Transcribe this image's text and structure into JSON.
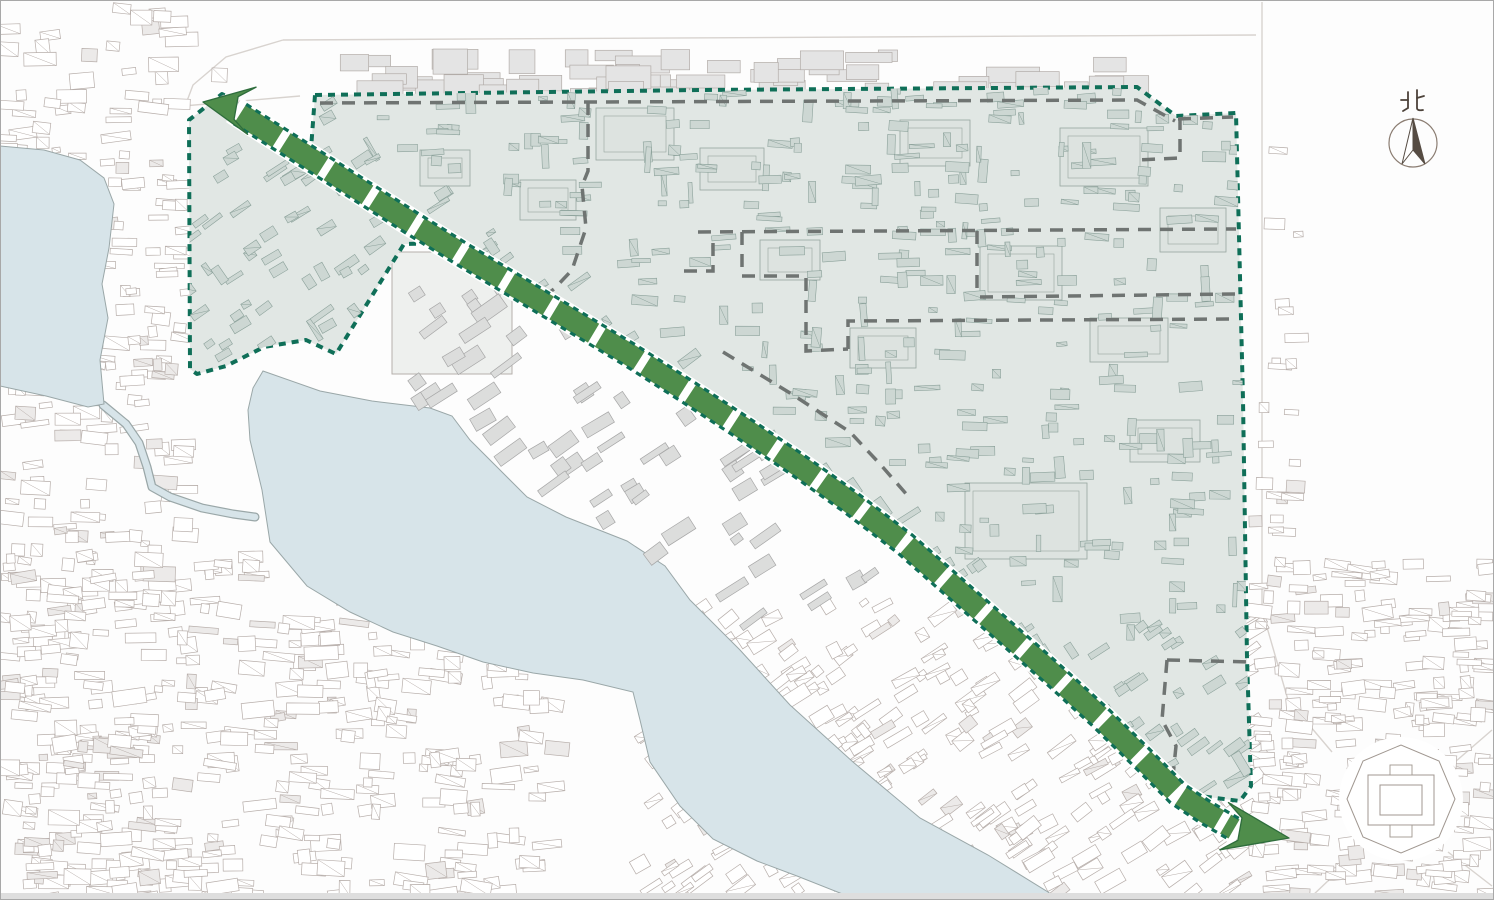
{
  "meta": {
    "width": 1494,
    "height": 900,
    "background": "#fdfdfd",
    "border_color": "#a8a8a8",
    "bottom_strip_color": "#dedede"
  },
  "compass": {
    "label": "北",
    "cx": 1413,
    "cy": 143,
    "r": 24,
    "ring_color": "#8b7d72",
    "needle_dark": "#564c43",
    "needle_light": "#ffffff",
    "label_color": "#4c423a"
  },
  "palette": {
    "water_fill": "#d7e4e9",
    "water_stroke": "#9aa7a8",
    "district_fill": "#e1e7e4",
    "district_boundary": "#0f6f58",
    "inside_bldg_fill": "#cdd7d3",
    "inside_bldg_stroke": "#8ba19a",
    "complex_fill": "#dde3e0",
    "complex_stroke": "#96a69f",
    "subzone_color": "#6f7472",
    "band_green": "#4f8d4b",
    "band_edge": "#0f6f58",
    "band_outline": "#2e6d3c",
    "road_color": "#d8d3cf",
    "outside_stroke": "#b7aeaa",
    "outside_fill": "#ffffff",
    "palace_fill": "#dcdddc",
    "palace_stroke": "#a7a7a7",
    "topstrip_fill": "#e4e4e4",
    "topstrip_stroke": "#b2aca8",
    "octagon_stroke": "#a09790"
  },
  "district": {
    "polygon": [
      [
        315,
        95
      ],
      [
        700,
        90
      ],
      [
        1137,
        87
      ],
      [
        1176,
        116
      ],
      [
        1236,
        113
      ],
      [
        1243,
        400
      ],
      [
        1247,
        658
      ],
      [
        1251,
        786
      ],
      [
        1240,
        801
      ],
      [
        1168,
        792
      ],
      [
        1128,
        748
      ],
      [
        1088,
        703
      ],
      [
        1046,
        662
      ],
      [
        996,
        618
      ],
      [
        946,
        574
      ],
      [
        896,
        530
      ],
      [
        841,
        488
      ],
      [
        786,
        449
      ],
      [
        731,
        412
      ],
      [
        676,
        376
      ],
      [
        621,
        341
      ],
      [
        566,
        308
      ],
      [
        511,
        275
      ],
      [
        456,
        243
      ],
      [
        404,
        244
      ],
      [
        336,
        354
      ],
      [
        306,
        340
      ],
      [
        264,
        347
      ],
      [
        226,
        366
      ],
      [
        197,
        374
      ],
      [
        190,
        369
      ],
      [
        189,
        120
      ],
      [
        222,
        94
      ],
      [
        256,
        111
      ],
      [
        290,
        133
      ],
      [
        311,
        149
      ]
    ],
    "boundary_width": 4,
    "boundary_dash": [
      7,
      6
    ]
  },
  "band": {
    "width": 22,
    "road_width": 29,
    "segment_dash": [
      45,
      8
    ],
    "edge_dash": [
      6,
      5
    ],
    "edge_width": 3.2,
    "edge_offset": 11.5,
    "centerline": [
      [
        240,
        114
      ],
      [
        300,
        152
      ],
      [
        355,
        187
      ],
      [
        410,
        222
      ],
      [
        465,
        256
      ],
      [
        520,
        289
      ],
      [
        575,
        322
      ],
      [
        630,
        355
      ],
      [
        685,
        390
      ],
      [
        740,
        426
      ],
      [
        795,
        463
      ],
      [
        850,
        502
      ],
      [
        905,
        544
      ],
      [
        955,
        588
      ],
      [
        1005,
        632
      ],
      [
        1055,
        676
      ],
      [
        1100,
        717
      ],
      [
        1140,
        756
      ],
      [
        1178,
        794
      ],
      [
        1205,
        812
      ],
      [
        1234,
        829
      ]
    ],
    "arrowheads": [
      {
        "tip": [
          203,
          102
        ],
        "base": [
          242,
          109
        ],
        "wing": 24,
        "back": 10,
        "notch": 11.5
      },
      {
        "tip": [
          1289,
          838
        ],
        "base": [
          1234,
          828
        ],
        "wing": 24,
        "back": 10,
        "notch": 11.5
      }
    ]
  },
  "water": {
    "big_lake": [
      [
        263,
        371
      ],
      [
        320,
        391
      ],
      [
        372,
        401
      ],
      [
        430,
        408
      ],
      [
        452,
        416
      ],
      [
        470,
        440
      ],
      [
        500,
        470
      ],
      [
        527,
        497
      ],
      [
        566,
        517
      ],
      [
        627,
        541
      ],
      [
        665,
        566
      ],
      [
        690,
        600
      ],
      [
        740,
        650
      ],
      [
        790,
        705
      ],
      [
        853,
        762
      ],
      [
        920,
        818
      ],
      [
        988,
        855
      ],
      [
        1048,
        892
      ],
      [
        1058,
        900
      ],
      [
        853,
        900
      ],
      [
        845,
        895
      ],
      [
        797,
        876
      ],
      [
        757,
        861
      ],
      [
        713,
        839
      ],
      [
        680,
        806
      ],
      [
        650,
        762
      ],
      [
        640,
        720
      ],
      [
        633,
        692
      ],
      [
        583,
        680
      ],
      [
        533,
        673
      ],
      [
        483,
        662
      ],
      [
        437,
        646
      ],
      [
        393,
        632
      ],
      [
        350,
        612
      ],
      [
        307,
        586
      ],
      [
        270,
        542
      ],
      [
        262,
        490
      ],
      [
        250,
        440
      ],
      [
        248,
        410
      ],
      [
        253,
        388
      ]
    ],
    "small_lake": [
      [
        0,
        146
      ],
      [
        44,
        150
      ],
      [
        80,
        160
      ],
      [
        104,
        178
      ],
      [
        114,
        204
      ],
      [
        109,
        248
      ],
      [
        102,
        284
      ],
      [
        108,
        318
      ],
      [
        100,
        360
      ],
      [
        104,
        404
      ],
      [
        88,
        407
      ],
      [
        46,
        396
      ],
      [
        0,
        386
      ]
    ],
    "canal": [
      [
        103,
        405
      ],
      [
        126,
        424
      ],
      [
        139,
        443
      ],
      [
        147,
        467
      ],
      [
        152,
        487
      ],
      [
        170,
        497
      ],
      [
        202,
        508
      ],
      [
        233,
        514
      ],
      [
        255,
        517
      ]
    ]
  },
  "subzones": {
    "width": 3.5,
    "dash": [
      13,
      9
    ],
    "lines": [
      [
        [
          320,
          103
        ],
        [
          1137,
          100
        ],
        [
          1175,
          121
        ]
      ],
      [
        [
          1178,
          119
        ],
        [
          1233,
          117
        ]
      ],
      [
        [
          588,
          102
        ],
        [
          588,
          171
        ],
        [
          582,
          186
        ],
        [
          586,
          228
        ],
        [
          572,
          270
        ],
        [
          554,
          289
        ],
        [
          534,
          304
        ]
      ],
      [
        [
          698,
          232
        ],
        [
          1236,
          229
        ]
      ],
      [
        [
          977,
          231
        ],
        [
          977,
          297
        ]
      ],
      [
        [
          980,
          297
        ],
        [
          1236,
          294
        ]
      ],
      [
        [
          742,
          232
        ],
        [
          742,
          276
        ],
        [
          806,
          276
        ],
        [
          806,
          351
        ],
        [
          848,
          349
        ]
      ],
      [
        [
          684,
          271
        ],
        [
          713,
          271
        ],
        [
          713,
          243
        ]
      ],
      [
        [
          848,
          349
        ],
        [
          848,
          321
        ],
        [
          1236,
          319
        ]
      ],
      [
        [
          723,
          352
        ],
        [
          790,
          393
        ],
        [
          850,
          432
        ],
        [
          880,
          464
        ],
        [
          908,
          496
        ]
      ],
      [
        [
          1167,
          660
        ],
        [
          1252,
          662
        ]
      ],
      [
        [
          1167,
          660
        ],
        [
          1162,
          720
        ],
        [
          1176,
          746
        ],
        [
          1172,
          786
        ]
      ],
      [
        [
          1180,
          117
        ],
        [
          1180,
          158
        ],
        [
          1137,
          160
        ]
      ]
    ]
  },
  "roads": {
    "width": 1.4,
    "lines": [
      [
        [
          283,
          40
        ],
        [
          1256,
          35
        ]
      ],
      [
        [
          283,
          40
        ],
        [
          226,
          57
        ],
        [
          193,
          85
        ],
        [
          184,
          109
        ]
      ],
      [
        [
          1262,
          2
        ],
        [
          1262,
          610
        ],
        [
          1288,
          700
        ],
        [
          1332,
          752
        ]
      ],
      [
        [
          1455,
          762
        ],
        [
          1492,
          730
        ]
      ],
      [
        [
          1448,
          852
        ],
        [
          1492,
          886
        ]
      ],
      [
        [
          1352,
          858
        ],
        [
          1310,
          898
        ]
      ],
      [
        [
          160,
          108
        ],
        [
          300,
          96
        ]
      ]
    ]
  },
  "palace": {
    "open_square": [
      392,
      252,
      120,
      122
    ]
  },
  "octagon": {
    "cx": 1401,
    "cy": 799,
    "ring": [
      [
        1347,
        799
      ],
      [
        1363,
        761
      ],
      [
        1401,
        745
      ],
      [
        1439,
        761
      ],
      [
        1455,
        799
      ],
      [
        1439,
        837
      ],
      [
        1401,
        853
      ],
      [
        1363,
        837
      ]
    ],
    "outer": [
      1368,
      775,
      66,
      50
    ],
    "inner": [
      1380,
      785,
      42,
      30
    ],
    "tab_top": [
      1390,
      765,
      22,
      10
    ],
    "tab_bottom": [
      1390,
      825,
      22,
      12
    ]
  },
  "complexes": [
    [
      596,
      108,
      78,
      52
    ],
    [
      700,
      148,
      64,
      42
    ],
    [
      980,
      246,
      82,
      54
    ],
    [
      1060,
      128,
      88,
      58
    ],
    [
      1160,
      208,
      66,
      44
    ],
    [
      850,
      328,
      66,
      40
    ],
    [
      1090,
      318,
      78,
      44
    ],
    [
      965,
      483,
      122,
      76
    ],
    [
      620,
      428,
      56,
      38
    ],
    [
      760,
      240,
      60,
      40
    ],
    [
      520,
      180,
      56,
      40
    ],
    [
      420,
      150,
      50,
      36
    ],
    [
      900,
      120,
      70,
      46
    ],
    [
      1130,
      420,
      70,
      42
    ]
  ],
  "textures": {
    "seed": 20240613,
    "inside": {
      "count": 950,
      "bbox": [
        188,
        84,
        1256,
        808
      ],
      "w": [
        8,
        26
      ],
      "h": [
        4,
        10
      ],
      "hatch": 0.4
    },
    "regions": [
      {
        "name": "left-strip",
        "bbox": [
          3,
          95,
          186,
          897
        ],
        "count": 260,
        "rot": 0,
        "jitter": 8,
        "w": [
          8,
          30
        ],
        "h": [
          5,
          14
        ]
      },
      {
        "name": "bottom-left",
        "bbox": [
          2,
          555,
          558,
          898
        ],
        "count": 340,
        "rot": 0,
        "jitter": 10,
        "w": [
          8,
          34
        ],
        "h": [
          5,
          16
        ]
      },
      {
        "name": "below-lake",
        "bbox": [
          640,
          600,
          1258,
          896
        ],
        "count": 330,
        "rot": -33,
        "jitter": 6,
        "w": [
          8,
          30
        ],
        "h": [
          5,
          14
        ]
      },
      {
        "name": "right-bottom",
        "bbox": [
          1256,
          560,
          1492,
          896
        ],
        "count": 230,
        "rot": 0,
        "jitter": 8,
        "w": [
          8,
          30
        ],
        "h": [
          5,
          14
        ]
      },
      {
        "name": "top-left-corner",
        "bbox": [
          2,
          6,
          240,
          88
        ],
        "count": 20,
        "rot": 0,
        "jitter": 8,
        "w": [
          12,
          34
        ],
        "h": [
          6,
          16
        ]
      },
      {
        "name": "between-lakes",
        "bbox": [
          118,
          118,
          186,
          392
        ],
        "count": 26,
        "rot": 0,
        "jitter": 6,
        "w": [
          8,
          26
        ],
        "h": [
          5,
          12
        ]
      },
      {
        "name": "right-of-district",
        "bbox": [
          1252,
          120,
          1300,
          555
        ],
        "count": 22,
        "rot": 0,
        "jitter": 4,
        "w": [
          8,
          24
        ],
        "h": [
          5,
          12
        ]
      }
    ],
    "top_strip": {
      "bbox": [
        332,
        48,
        1142,
        92
      ],
      "count": 60,
      "w": [
        18,
        55
      ],
      "h": [
        10,
        26
      ]
    },
    "palace_region": {
      "bbox": [
        405,
        255,
        880,
        625
      ],
      "count": 130,
      "rot": -33,
      "jitter": 4,
      "w": [
        10,
        34
      ],
      "h": [
        6,
        16
      ]
    }
  }
}
